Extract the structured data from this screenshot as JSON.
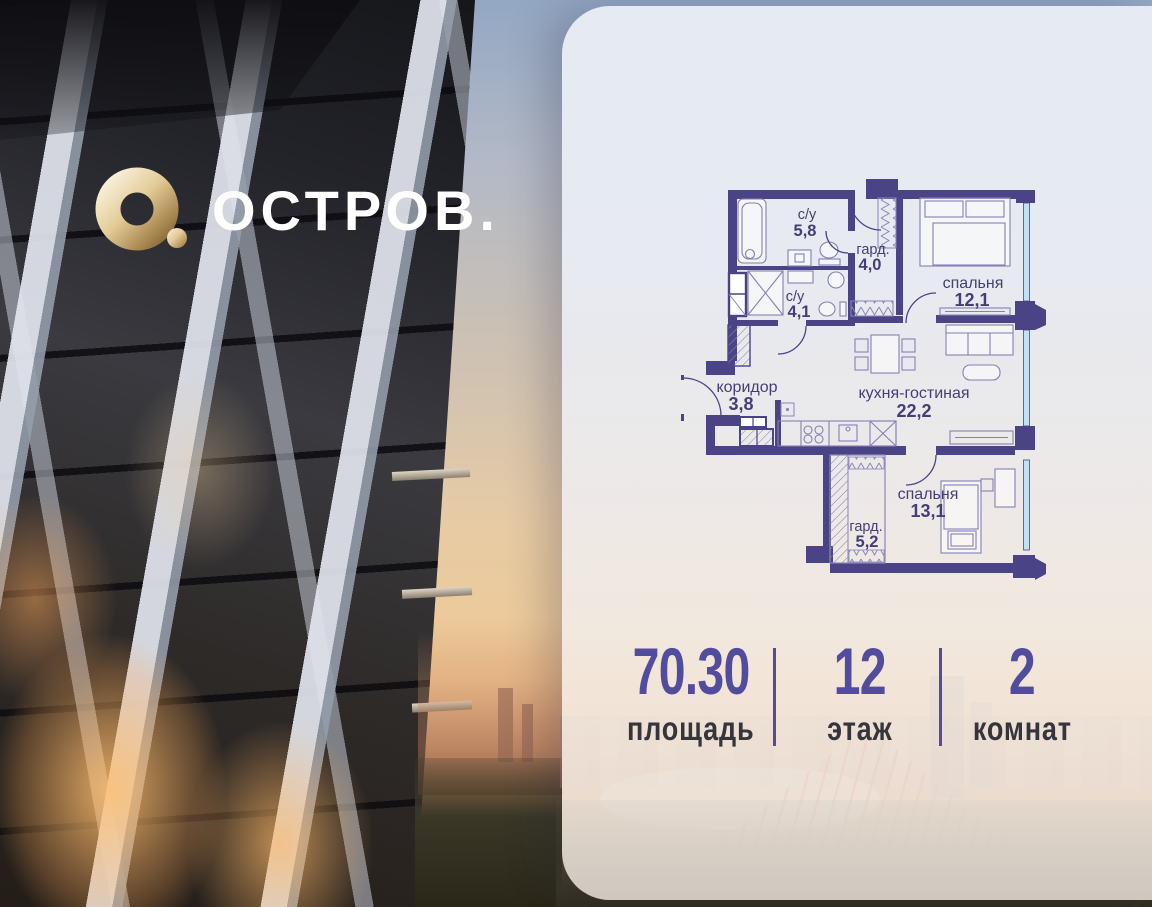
{
  "brand": {
    "logo_text": "ОСТРОВ."
  },
  "floor_plan": {
    "rooms": [
      {
        "name": "с/у",
        "area": "5,8"
      },
      {
        "name": "гард.",
        "area": "4,0"
      },
      {
        "name": "спальня",
        "area": "12,1"
      },
      {
        "name": "с/у",
        "area": "4,1"
      },
      {
        "name": "коридор",
        "area": "3,8"
      },
      {
        "name": "кухня-гостиная",
        "area": "22,2"
      },
      {
        "name": "спальня",
        "area": "13,1"
      },
      {
        "name": "гард.",
        "area": "5,2"
      }
    ]
  },
  "stats": {
    "items": [
      {
        "value": "70.30",
        "label": "площадь"
      },
      {
        "value": "12",
        "label": "этаж"
      },
      {
        "value": "2",
        "label": "комнат"
      }
    ]
  },
  "colors": {
    "wall": "#4a4486",
    "accent_purple": "#524c9e",
    "window_blue": "#bfe2f6",
    "logo_gold": "#d9bf8a"
  }
}
